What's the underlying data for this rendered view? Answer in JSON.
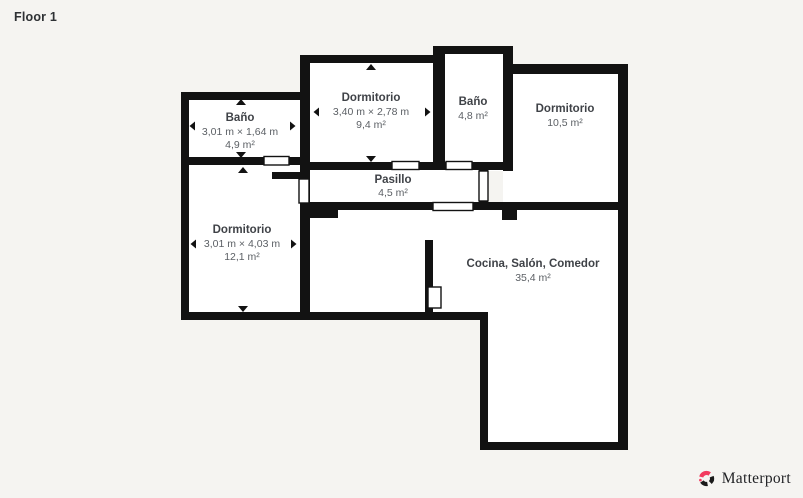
{
  "page": {
    "floor_label": "Floor 1",
    "background_color": "#f5f4f1"
  },
  "colors": {
    "wall": "#121212",
    "room_fill": "#ffffff",
    "room_name_text": "#3f4247",
    "room_detail_text": "#5c6065",
    "brand_pink": "#f23a5e",
    "brand_black": "#1f2023"
  },
  "rooms": [
    {
      "id": "bano-1",
      "name": "Baño",
      "dimensions": "3,01 m × 1,64 m",
      "area": "4,9 m²"
    },
    {
      "id": "dormitorio-1",
      "name": "Dormitorio",
      "dimensions": "3,40 m × 2,78 m",
      "area": "9,4 m²"
    },
    {
      "id": "bano-2",
      "name": "Baño",
      "dimensions": "",
      "area": "4,8 m²"
    },
    {
      "id": "dormitorio-2",
      "name": "Dormitorio",
      "dimensions": "",
      "area": "10,5 m²"
    },
    {
      "id": "pasillo",
      "name": "Pasillo",
      "dimensions": "",
      "area": "4,5 m²"
    },
    {
      "id": "dormitorio-3",
      "name": "Dormitorio",
      "dimensions": "3,01 m × 4,03 m",
      "area": "12,1 m²"
    },
    {
      "id": "cocina",
      "name": "Cocina, Salón, Comedor",
      "dimensions": "",
      "area": "35,4 m²"
    }
  ],
  "branding": {
    "logo_text": "Matterport",
    "logo_icon": "matterport-pinwheel-icon"
  }
}
